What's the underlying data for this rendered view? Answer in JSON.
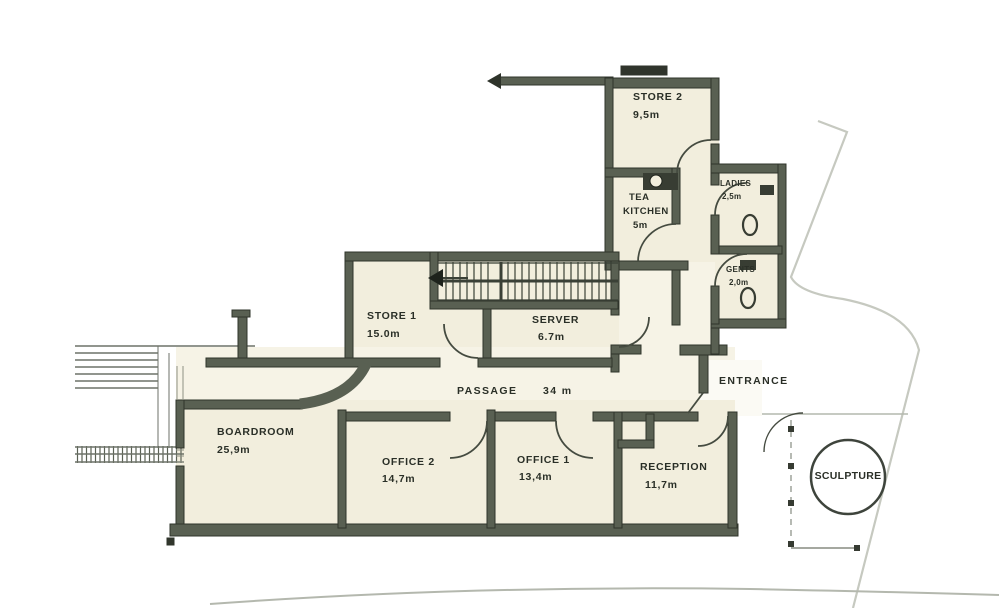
{
  "plan": {
    "rooms": {
      "store2": {
        "name": "STORE 2",
        "area": "9,5m"
      },
      "tea_kitchen": {
        "line1": "TEA",
        "line2": "KITCHEN",
        "area": "5m"
      },
      "ladies": {
        "name": "LADIES",
        "area": "2,5m"
      },
      "gents": {
        "name": "GENTS",
        "area": "2,0m"
      },
      "store1": {
        "name": "STORE 1",
        "area": "15.0m"
      },
      "server": {
        "name": "SERVER",
        "area": "6.7m"
      },
      "boardroom": {
        "name": "BOARDROOM",
        "area": "25,9m"
      },
      "office2": {
        "name": "OFFICE 2",
        "area": "14,7m"
      },
      "office1": {
        "name": "OFFICE 1",
        "area": "13,4m"
      },
      "reception": {
        "name": "RECEPTION",
        "area": "11,7m"
      }
    },
    "passage": {
      "name": "PASSAGE",
      "length": "34 m"
    },
    "entrance_label": "ENTRANCE",
    "sculpture_label": "SCULPTURE",
    "icons": {
      "stairs_direction": "left-arrow"
    },
    "colors": {
      "wall": "#596052",
      "wall_dark": "#31362c",
      "room_fill": "#f2eedd",
      "corridor_fill": "#f6f3e6",
      "boundary_line": "#c6c9c0",
      "site_line": "#b4b8ae"
    }
  }
}
